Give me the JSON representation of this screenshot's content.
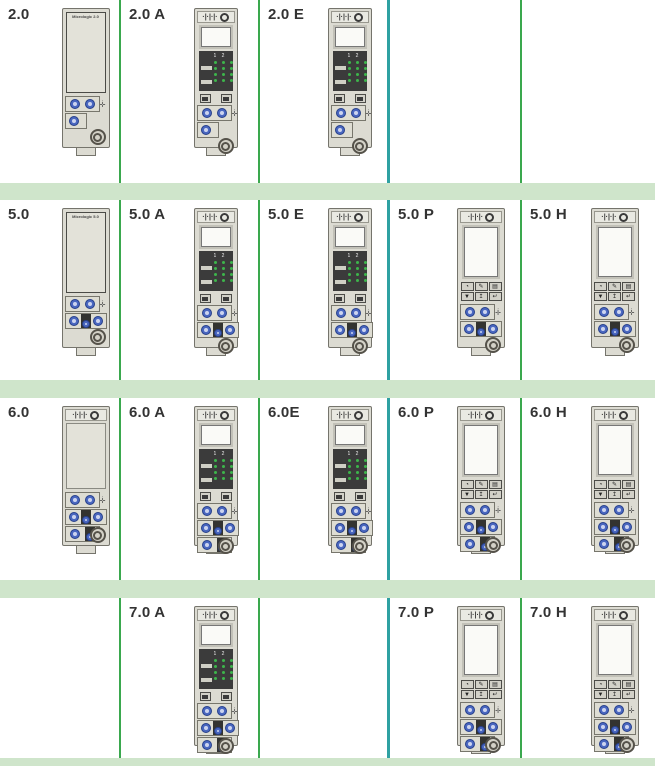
{
  "colors": {
    "band": "#cfe5cb",
    "line_green": "#3aa84e",
    "line_teal": "#2fa1a2",
    "label_text": "#333333",
    "device_body": "#dcdbd2",
    "device_border": "#75746c",
    "panel_face": "#e3e2d9",
    "panel_border": "#4b4b47",
    "lcd_frame": "#c2c1b8",
    "lcd_screen": "#fafaf7",
    "led_panel": "#3b3b3b",
    "led_green": "#3db54b",
    "dial_blue": "#4a67c0",
    "dial_border": "#27408b",
    "dial_center": "#ccd4ef",
    "switch_dark": "#333330",
    "button_face": "#d2d1c8",
    "button_border": "#4c4c48",
    "test_ring": "#55524a"
  },
  "icons": {
    "sensor_ports": "·|·|·|·",
    "sensor_ring": "target-circle",
    "side_plug_top": "·",
    "side_plug_bottom": "✛",
    "led_header": "1 2 3",
    "ae_buttons": [
      "battery-test-button",
      "lamp-test-button"
    ],
    "ph_button_glyphs": [
      [
        "◔",
        "✎",
        "▤"
      ],
      [
        "▼",
        "↥",
        "↵"
      ]
    ]
  },
  "table": {
    "columns": [
      121,
      139,
      130,
      132,
      133
    ],
    "separators": [
      "green",
      "green",
      "teal",
      "green"
    ],
    "band_heights": [
      17,
      18,
      18,
      8
    ],
    "rows": [
      {
        "height": 183,
        "cells": [
          {
            "label": "2.0",
            "device": {
              "type": "base",
              "face_text": "Micrologic 2.0",
              "dials": "2-1"
            }
          },
          {
            "label": "2.0 A",
            "device": {
              "type": "ae",
              "dials": "2-1"
            }
          },
          {
            "label": "2.0 E",
            "device": {
              "type": "ae",
              "dials": "2-1"
            }
          },
          {
            "label": ""
          },
          {
            "label": ""
          }
        ]
      },
      {
        "height": 180,
        "cells": [
          {
            "label": "5.0",
            "device": {
              "type": "base",
              "face_text": "Micrologic 5.0",
              "dials": "2-3"
            }
          },
          {
            "label": "5.0 A",
            "device": {
              "type": "ae",
              "dials": "2-3"
            }
          },
          {
            "label": "5.0 E",
            "device": {
              "type": "ae",
              "dials": "2-3"
            }
          },
          {
            "label": "5.0 P",
            "device": {
              "type": "ph",
              "dials": "2-3"
            }
          },
          {
            "label": "5.0 H",
            "device": {
              "type": "ph",
              "dials": "2-3"
            }
          }
        ]
      },
      {
        "height": 182,
        "cells": [
          {
            "label": "6.0",
            "device": {
              "type": "base-icon",
              "dials": "2-3-2"
            }
          },
          {
            "label": "6.0 A",
            "device": {
              "type": "ae",
              "dials": "2-3-2"
            }
          },
          {
            "label": "6.0E",
            "device": {
              "type": "ae",
              "dials": "2-3-2"
            }
          },
          {
            "label": "6.0 P",
            "device": {
              "type": "ph",
              "dials": "2-3-2"
            }
          },
          {
            "label": "6.0 H",
            "device": {
              "type": "ph",
              "dials": "2-3-2"
            }
          }
        ]
      },
      {
        "height": 160,
        "cells": [
          {
            "label": ""
          },
          {
            "label": "7.0 A",
            "device": {
              "type": "ae",
              "dials": "2-3-2"
            }
          },
          {
            "label": ""
          },
          {
            "label": "7.0 P",
            "device": {
              "type": "ph",
              "dials": "2-3-2"
            }
          },
          {
            "label": "7.0 H",
            "device": {
              "type": "ph",
              "dials": "2-3-2"
            }
          }
        ]
      }
    ]
  }
}
